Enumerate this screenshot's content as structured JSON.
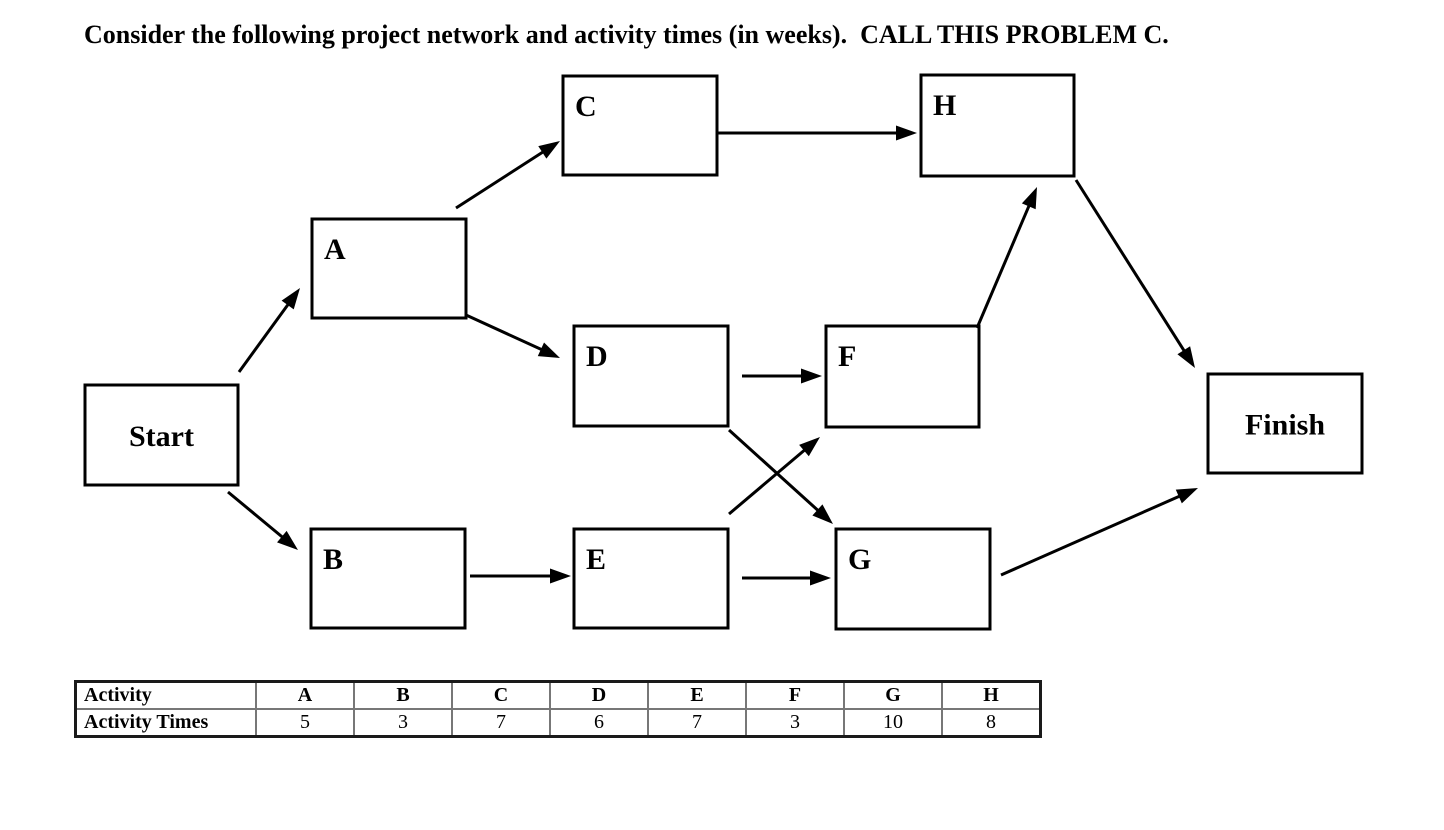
{
  "title": "Consider the following project network and activity times (in weeks).  CALL THIS PROBLEM C.",
  "network": {
    "nodes": [
      {
        "id": "start",
        "label": "Start",
        "x": 85,
        "y": 385,
        "w": 153,
        "h": 100,
        "align": "center"
      },
      {
        "id": "A",
        "label": "A",
        "x": 312,
        "y": 219,
        "w": 154,
        "h": 99,
        "align": "topleft"
      },
      {
        "id": "B",
        "label": "B",
        "x": 311,
        "y": 529,
        "w": 154,
        "h": 99,
        "align": "topleft"
      },
      {
        "id": "C",
        "label": "C",
        "x": 563,
        "y": 76,
        "w": 154,
        "h": 99,
        "align": "topleft"
      },
      {
        "id": "D",
        "label": "D",
        "x": 574,
        "y": 326,
        "w": 154,
        "h": 100,
        "align": "topleft"
      },
      {
        "id": "E",
        "label": "E",
        "x": 574,
        "y": 529,
        "w": 154,
        "h": 99,
        "align": "topleft"
      },
      {
        "id": "F",
        "label": "F",
        "x": 826,
        "y": 326,
        "w": 153,
        "h": 101,
        "align": "topleft"
      },
      {
        "id": "G",
        "label": "G",
        "x": 836,
        "y": 529,
        "w": 154,
        "h": 100,
        "align": "topleft"
      },
      {
        "id": "H",
        "label": "H",
        "x": 921,
        "y": 75,
        "w": 153,
        "h": 101,
        "align": "topleft"
      },
      {
        "id": "finish",
        "label": "Finish",
        "x": 1208,
        "y": 374,
        "w": 154,
        "h": 99,
        "align": "center"
      }
    ],
    "edges": [
      {
        "from": "start",
        "to": "A",
        "x1": 239,
        "y1": 372,
        "x2": 300,
        "y2": 288
      },
      {
        "from": "start",
        "to": "B",
        "x1": 228,
        "y1": 492,
        "x2": 298,
        "y2": 550
      },
      {
        "from": "A",
        "to": "C",
        "x1": 456,
        "y1": 208,
        "x2": 560,
        "y2": 141
      },
      {
        "from": "A",
        "to": "D",
        "x1": 466,
        "y1": 315,
        "x2": 560,
        "y2": 358
      },
      {
        "from": "B",
        "to": "E",
        "x1": 470,
        "y1": 576,
        "x2": 571,
        "y2": 576
      },
      {
        "from": "C",
        "to": "H",
        "x1": 716,
        "y1": 133,
        "x2": 917,
        "y2": 133
      },
      {
        "from": "D",
        "to": "F",
        "x1": 742,
        "y1": 376,
        "x2": 822,
        "y2": 376
      },
      {
        "from": "D",
        "to": "G",
        "x1": 729,
        "y1": 430,
        "x2": 833,
        "y2": 524
      },
      {
        "from": "E",
        "to": "F",
        "x1": 729,
        "y1": 514,
        "x2": 820,
        "y2": 437
      },
      {
        "from": "E",
        "to": "G",
        "x1": 742,
        "y1": 578,
        "x2": 831,
        "y2": 578
      },
      {
        "from": "F",
        "to": "H",
        "x1": 977,
        "y1": 328,
        "x2": 1037,
        "y2": 187
      },
      {
        "from": "H",
        "to": "finish",
        "x1": 1076,
        "y1": 180,
        "x2": 1195,
        "y2": 368
      },
      {
        "from": "G",
        "to": "finish",
        "x1": 1001,
        "y1": 575,
        "x2": 1198,
        "y2": 488
      }
    ]
  },
  "table": {
    "rows": [
      {
        "label": "Activity",
        "cells": [
          "A",
          "B",
          "C",
          "D",
          "E",
          "F",
          "G",
          "H"
        ]
      },
      {
        "label": "Activity Times",
        "cells": [
          "5",
          "3",
          "7",
          "6",
          "7",
          "3",
          "10",
          "8"
        ]
      }
    ]
  },
  "colors": {
    "ink": "#000000",
    "background": "#ffffff",
    "table_inner_border": "#777777",
    "table_outer_border": "#1a1a1a"
  }
}
